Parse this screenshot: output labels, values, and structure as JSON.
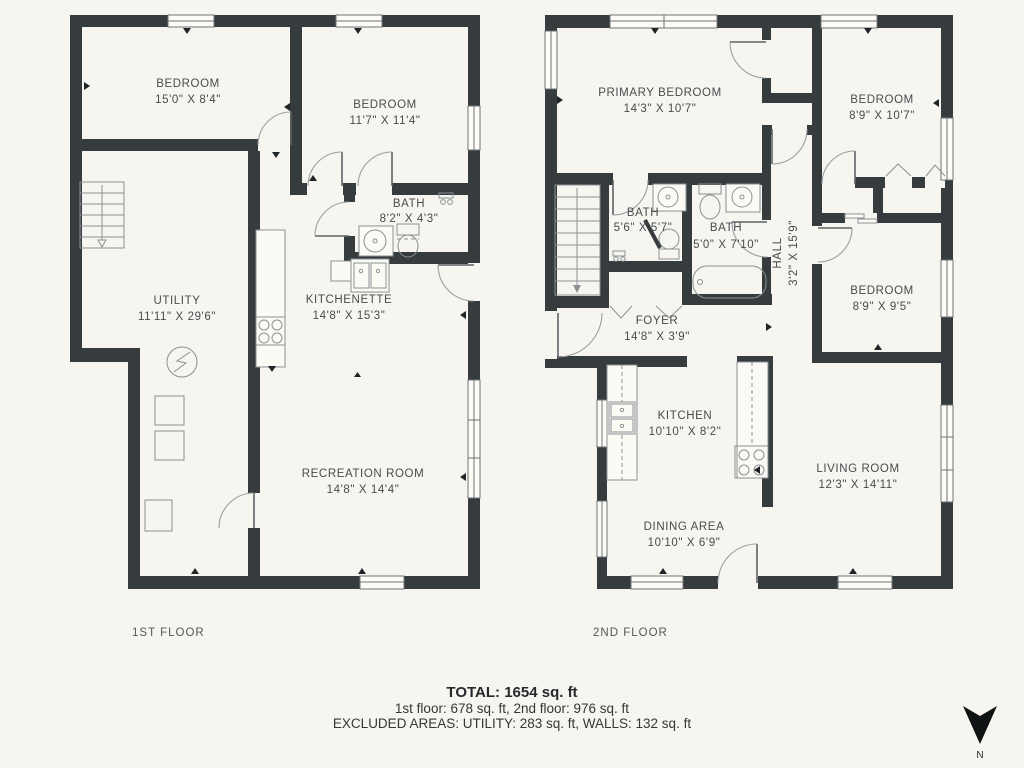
{
  "floor1": {
    "label": "1ST FLOOR",
    "rooms": [
      {
        "name": "BEDROOM",
        "dims": "15'0\" X 8'4\""
      },
      {
        "name": "BEDROOM",
        "dims": "11'7\" X 11'4\""
      },
      {
        "name": "BATH",
        "dims": "8'2\" X 4'3\""
      },
      {
        "name": "UTILITY",
        "dims": "11'11\" X 29'6\""
      },
      {
        "name": "KITCHENETTE",
        "dims": "14'8\" X 15'3\""
      },
      {
        "name": "RECREATION ROOM",
        "dims": "14'8\" X 14'4\""
      }
    ]
  },
  "floor2": {
    "label": "2ND FLOOR",
    "rooms": [
      {
        "name": "PRIMARY BEDROOM",
        "dims": "14'3\" X 10'7\""
      },
      {
        "name": "BEDROOM",
        "dims": "8'9\" X 10'7\""
      },
      {
        "name": "BATH",
        "dims": "5'6\" X 5'7\""
      },
      {
        "name": "BATH",
        "dims": "5'0\" X 7'10\""
      },
      {
        "name": "HALL",
        "dims": "3'2\" X 15'9\""
      },
      {
        "name": "FOYER",
        "dims": "14'8\" X 3'9\""
      },
      {
        "name": "BEDROOM",
        "dims": "8'9\" X 9'5\""
      },
      {
        "name": "KITCHEN",
        "dims": "10'10\" X 8'2\""
      },
      {
        "name": "DINING AREA",
        "dims": "10'10\" X 6'9\""
      },
      {
        "name": "LIVING ROOM",
        "dims": "12'3\" X 14'11\""
      }
    ]
  },
  "summary": {
    "total": "TOTAL: 1654 sq. ft",
    "floors": "1st floor: 678 sq. ft, 2nd floor: 976 sq. ft",
    "excluded": "EXCLUDED AREAS: UTILITY: 283 sq. ft, WALLS: 132 sq. ft"
  },
  "compass": {
    "label": "N"
  },
  "colors": {
    "background": "#f6f5ef",
    "walls": "#363b3e",
    "text": "#474c4f"
  }
}
